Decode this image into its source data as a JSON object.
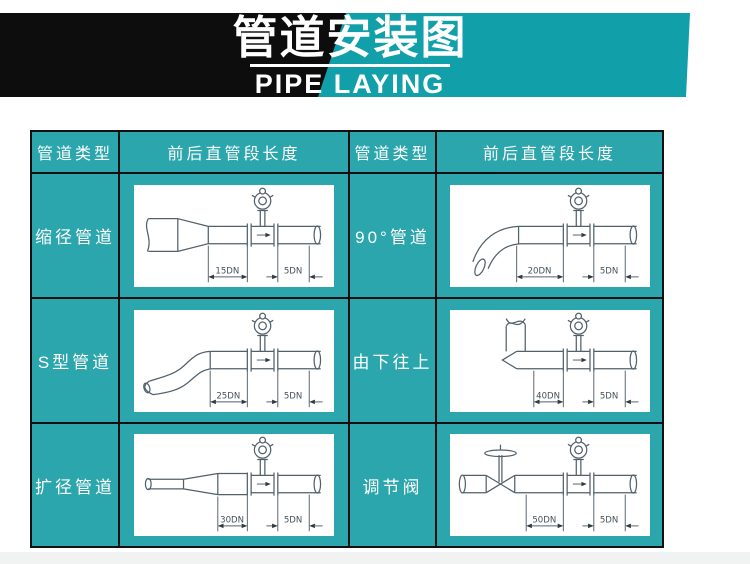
{
  "banner": {
    "title": "管道安装图",
    "subtitle": "PIPE LAYING"
  },
  "table": {
    "headers": [
      "管道类型",
      "前后直管段长度",
      "管道类型",
      "前后直管段长度"
    ],
    "rows": [
      {
        "left": {
          "type": "缩径管道",
          "upstream": "15DN",
          "downstream": "5DN"
        },
        "right": {
          "type": "90°管道",
          "upstream": "20DN",
          "downstream": "5DN"
        }
      },
      {
        "left": {
          "type": "S型管道",
          "upstream": "25DN",
          "downstream": "5DN"
        },
        "right": {
          "type": "由下往上",
          "upstream": "40DN",
          "downstream": "5DN"
        }
      },
      {
        "left": {
          "type": "扩径管道",
          "upstream": "30DN",
          "downstream": "5DN"
        },
        "right": {
          "type": "调节阀",
          "upstream": "50DN",
          "downstream": "5DN"
        }
      }
    ]
  },
  "colors": {
    "banner_teal": "#119fa9",
    "banner_black": "#0d0d0d",
    "cell_teal": "#2ba6ac",
    "grid_line": "#101010",
    "diagram_line": "#52606a",
    "text_white": "#ffffff"
  }
}
